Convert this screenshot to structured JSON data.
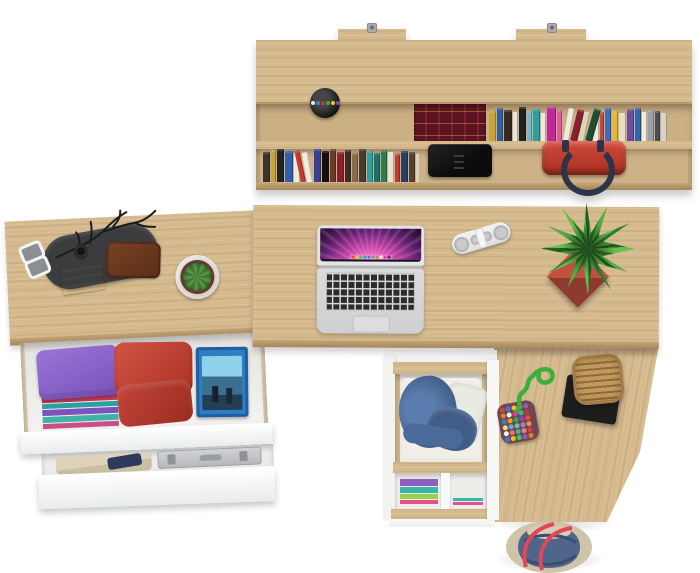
{
  "meta": {
    "subject": "Top-down view of oak home-office furniture set: wall shelf with books, L-shaped desk with laptop, open drawers with clothes and accessories",
    "background": "#ffffff"
  },
  "palette": {
    "wood": "#d5ba8e",
    "wood_shade": "#c9ad7e",
    "wood_edge": "#a5875c",
    "drawer_white": "#f7f7f7"
  },
  "hutch": {
    "label": "wall-mounted shelf",
    "bracket_color": "#9b9b9b",
    "pen_cup": {
      "cup": "#1c1c1c",
      "pens": [
        "#e8e8e8",
        "#3a86c9",
        "#c0392b",
        "#27ae60",
        "#f1c40f",
        "#8e44ad"
      ]
    },
    "maroon_books": {
      "base": "#5c1422",
      "stripe": "#7c2130",
      "gold": "#caa84e"
    },
    "books_upper": [
      {
        "c": "#caa23a",
        "w": 7,
        "h": 30
      },
      {
        "c": "#2e5fa3",
        "w": 6,
        "h": 33
      },
      {
        "c": "#3a2b22",
        "w": 8,
        "h": 31
      },
      {
        "c": "#e8e4da",
        "w": 5,
        "h": 29
      },
      {
        "c": "#22211f",
        "w": 7,
        "h": 34
      },
      {
        "c": "#7ab6c9",
        "w": 5,
        "h": 30
      },
      {
        "c": "#2aa0a0",
        "w": 7,
        "h": 32
      },
      {
        "c": "#ece8df",
        "w": 5,
        "h": 28
      },
      {
        "c": "#c0289a",
        "w": 9,
        "h": 34
      },
      {
        "c": "#e05aa0",
        "w": 5,
        "h": 31
      },
      {
        "c": "#efe9e0",
        "w": 6,
        "h": 33,
        "r": 10
      },
      {
        "c": "#8a1f2e",
        "w": 7,
        "h": 32,
        "r": 14
      },
      {
        "c": "#ddd3b8",
        "w": 6,
        "h": 30,
        "r": 12
      },
      {
        "c": "#1f4d2e",
        "w": 7,
        "h": 33,
        "r": 16
      },
      {
        "c": "#f0ece3",
        "w": 6,
        "h": 31
      },
      {
        "c": "#c94a3a",
        "w": 4,
        "h": 29
      },
      {
        "c": "#3a6fc0",
        "w": 6,
        "h": 33
      },
      {
        "c": "#e3b93c",
        "w": 6,
        "h": 30
      },
      {
        "c": "#e8ddc2",
        "w": 7,
        "h": 28
      },
      {
        "c": "#6a4fa0",
        "w": 7,
        "h": 32
      },
      {
        "c": "#2f66b0",
        "w": 6,
        "h": 33
      },
      {
        "c": "#f1ede4",
        "w": 5,
        "h": 29
      },
      {
        "c": "#9aa0a8",
        "w": 6,
        "h": 31
      },
      {
        "c": "#4a4e55",
        "w": 5,
        "h": 30
      },
      {
        "c": "#d8d4ca",
        "w": 6,
        "h": 28
      }
    ],
    "books_lower": [
      {
        "c": "#3a342c",
        "w": 7,
        "h": 30
      },
      {
        "c": "#c8a23a",
        "w": 5,
        "h": 32
      },
      {
        "c": "#262220",
        "w": 7,
        "h": 33
      },
      {
        "c": "#2f5fae",
        "w": 8,
        "h": 31
      },
      {
        "c": "#efe9df",
        "w": 6,
        "h": 29
      },
      {
        "c": "#c23b30",
        "w": 5,
        "h": 32,
        "r": -12
      },
      {
        "c": "#efeadf",
        "w": 6,
        "h": 30,
        "r": -10
      },
      {
        "c": "#3b3f8f",
        "w": 7,
        "h": 33
      },
      {
        "c": "#14100e",
        "w": 7,
        "h": 31
      },
      {
        "c": "#6b3a28",
        "w": 6,
        "h": 33
      },
      {
        "c": "#8a1f2e",
        "w": 7,
        "h": 30
      },
      {
        "c": "#3a2e26",
        "w": 6,
        "h": 32
      },
      {
        "c": "#8a6a4a",
        "w": 6,
        "h": 29
      },
      {
        "c": "#4a3a2e",
        "w": 7,
        "h": 33
      },
      {
        "c": "#2aa0a0",
        "w": 6,
        "h": 31
      },
      {
        "c": "#1f6f6f",
        "w": 6,
        "h": 29
      },
      {
        "c": "#2e7d4f",
        "w": 6,
        "h": 32
      },
      {
        "c": "#e8e2d6",
        "w": 6,
        "h": 30
      },
      {
        "c": "#c23b30",
        "w": 5,
        "h": 28
      },
      {
        "c": "#24405e",
        "w": 7,
        "h": 31
      },
      {
        "c": "#55412e",
        "w": 6,
        "h": 30
      },
      {
        "c": "#d8d0c0",
        "w": 5,
        "h": 28
      }
    ],
    "device_color": "#151515",
    "handbag": {
      "body": "#c23a30",
      "handles": "#2c3448"
    }
  },
  "left_desk": {
    "tray_color": "#3a3c3e",
    "sticky_notes": "#e9e06f",
    "wallet": "#6f3a22",
    "watch": "#141414",
    "sunglasses": "#f4f4f2",
    "branch": "#1c1c1c",
    "cactus": {
      "pot": "#f2f2ef",
      "soil": "#4a3a2c",
      "body": "#3f7a2e",
      "spines": "#b05a4a"
    },
    "drawer_top": {
      "stack_strips": [
        {
          "c": "#d24a86",
          "h": 6
        },
        {
          "c": "#caa23a",
          "h": 5
        },
        {
          "c": "#3fb3a5",
          "h": 6
        },
        {
          "c": "#c23b5a",
          "h": 6
        },
        {
          "c": "#2aa0a0",
          "h": 5
        },
        {
          "c": "#7b52c0",
          "h": 6
        },
        {
          "c": "#3fb3a5",
          "h": 6
        },
        {
          "c": "#c94f86",
          "h": 5
        }
      ],
      "stack_top": "#8a63c9",
      "towels": [
        "#c64a3e",
        "#b23a30"
      ],
      "disc_case": {
        "shell": "#2f7dc3",
        "art_sky": "#8fd0ea",
        "art_dark": "#223f55"
      }
    },
    "drawer_bottom": {
      "clothes_beige": "#ddd2ba",
      "clothes_navy": "#2e3a5c",
      "case_shell": "#c6c8ca",
      "case_latch": "#8f9296"
    }
  },
  "main_desk": {
    "laptop": {
      "shell": "#d7d8da",
      "bezel": "#131318",
      "hinge": "#b4b5b7",
      "key": "#2b2c2e",
      "trackpad": "#dcdddf",
      "wallpaper": {
        "inner": "#ffb6e8",
        "mid": "#ef63c0",
        "outer": "#5d1d6b",
        "edge": "#1d0a28"
      },
      "dock_icons": [
        "#e74c3c",
        "#f1c40f",
        "#2ecc71",
        "#3498db",
        "#9b59b6",
        "#1abc9c",
        "#e67e22",
        "#ecf0f1",
        "#e84393",
        "#34495e"
      ]
    },
    "speaker": {
      "body": "#ededee",
      "grille": "#c2c3c5",
      "dots": [
        {
          "c": "#c9cacb",
          "w": 15,
          "h": 15
        },
        {
          "c": "#c9cacb",
          "w": 10,
          "h": 10
        },
        {
          "c": "#c9cacb",
          "w": 10,
          "h": 10
        },
        {
          "c": "#c9cacb",
          "w": 15,
          "h": 15
        }
      ]
    },
    "plant": {
      "pot_light": "#c05040",
      "pot_dark": "#8f3a30",
      "leaf_dark": "#1f5f25",
      "leaf_mid": "#2e7d32",
      "leaf_light": "#67c04e"
    }
  },
  "pedestal": {
    "denim": "#45648f",
    "denim_dark": "#3f5d87",
    "shirt": "#e9ebe2",
    "lower_clothes": [
      {
        "c": "#8e5fc0",
        "h": 7
      },
      {
        "c": "#35b8a8",
        "h": 6
      },
      {
        "c": "#9ad14a",
        "h": 5
      },
      {
        "c": "#e5518a",
        "h": 4
      }
    ],
    "lower_clothes_right": [
      {
        "c": "#35b8a8",
        "h": 3
      },
      {
        "c": "#e5518a",
        "h": 3
      }
    ]
  },
  "return_desk": {
    "pouch": {
      "base": "#6f4652",
      "cord": "#3cae3c",
      "beads": [
        "#d94040",
        "#3a7ad9",
        "#f1c40f",
        "#2ecc71",
        "#9b59b6",
        "#e67e22",
        "#ecf0f1",
        "#d94090",
        "#35b8a8",
        "#c0392b",
        "#2e86c1",
        "#f39c12",
        "#27ae60",
        "#8e44ad",
        "#e74c3c",
        "#f7dc6f",
        "#5dade2",
        "#58d68d",
        "#af7ac5",
        "#eb984e",
        "#f0f3f4",
        "#ec7063",
        "#45b39d",
        "#d98880",
        "#d94040",
        "#3a7ad9",
        "#f1c40f",
        "#2ecc71",
        "#9b59b6",
        "#e67e22"
      ]
    },
    "basket": {
      "weave_light": "#c29a5e",
      "weave_dark": "#8f6a3a",
      "stand": "#1d1d1d"
    }
  },
  "tote": {
    "body": "#4d6689",
    "trim": "#cfc3a9",
    "interior": "#d8cdb4",
    "straps": "#e0485a",
    "fold": "#3a4f73"
  }
}
